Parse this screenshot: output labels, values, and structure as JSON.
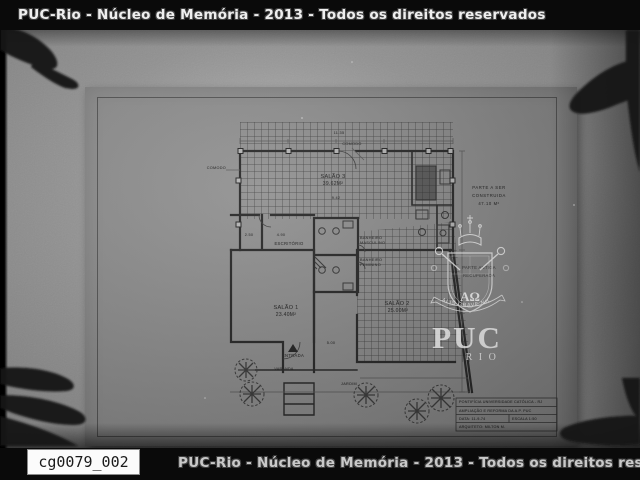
{
  "header": {
    "watermark_text": "PUC-Rio - Núcleo de Memória - 2013 - Todos os direitos reservados"
  },
  "footer": {
    "watermark_text": "PUC-Rio - Núcleo de Memória - 2013 - Todos os direitos reservados",
    "catalog_id": "cg0079_002"
  },
  "stamp": {
    "org": "PUC",
    "city": "RIO",
    "motto": "ALIS GRAVE NIL",
    "monogram": "ΑΩ"
  },
  "plan": {
    "rooms": {
      "salao3": {
        "name": "SALÃO 3",
        "area": "39.62M²"
      },
      "salao1": {
        "name": "SALÃO 1",
        "area": "23.40M²"
      },
      "salao2": {
        "name": "SALÃO 2",
        "area": "25.00M²"
      },
      "escritorio": "ESCRITÓRIO",
      "banheiro_masculino_l1": "BANHEIRO",
      "banheiro_masculino_l2": "MASCULINO",
      "banheiro_feminino_l1": "BANHEIRO",
      "banheiro_feminino_l2": "FEMININO"
    },
    "labels": {
      "comodo_top": "COMODO",
      "comodo_left": "COMODO",
      "entrada": "ENTRADA",
      "varanda": "VARANDA",
      "jardim": "JARDIM"
    },
    "notes": {
      "parte_nova_l1": "PARTE A SER",
      "parte_nova_l2": "CONSTRUIDA",
      "parte_nova_l3": "47.10 M²",
      "parte_antiga_l1": "PARTE ANTIGA",
      "parte_antiga_l2": "RECUPERADA"
    },
    "dims": {
      "top": "11.35",
      "salao3": "9.42",
      "varanda": "5.00",
      "d1": "2.50",
      "d2": "4.90"
    },
    "title_block": {
      "line1": "PONTIFÍCIA UNIVERSIDADE CATÓLICA - RJ",
      "line2": "AMPLIAÇÃO E REFORMA DA A.P. PUC",
      "date": "DATA: 11-9-74",
      "scale": "ESCALA 1:50",
      "architect": "ARQUITETO: MILTON M."
    }
  }
}
